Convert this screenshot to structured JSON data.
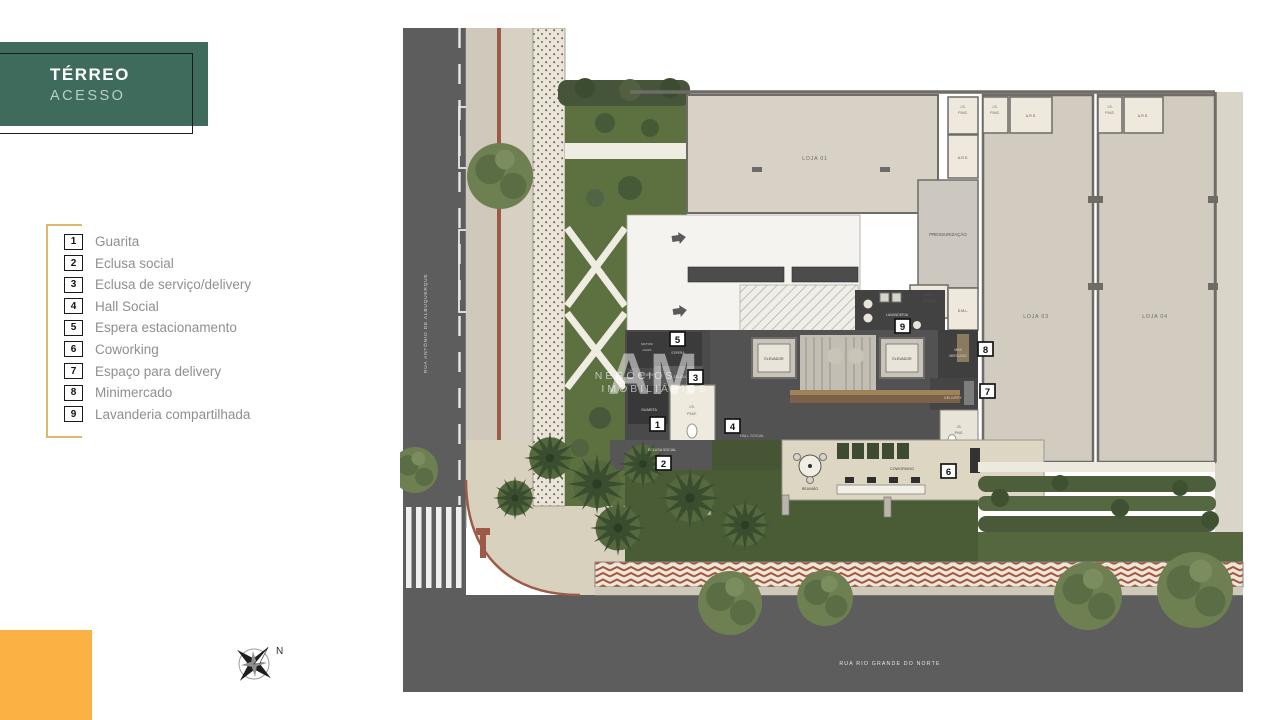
{
  "header": {
    "title": "TÉRREO",
    "subtitle": "ACESSO"
  },
  "legend": {
    "items": [
      {
        "num": "1",
        "label": "Guarita"
      },
      {
        "num": "2",
        "label": "Eclusa social"
      },
      {
        "num": "3",
        "label": "Eclusa de serviço/delivery"
      },
      {
        "num": "4",
        "label": "Hall Social"
      },
      {
        "num": "5",
        "label": "Espera estacionamento"
      },
      {
        "num": "6",
        "label": "Coworking"
      },
      {
        "num": "7",
        "label": "Espaço para delivery"
      },
      {
        "num": "8",
        "label": "Minimercado"
      },
      {
        "num": "9",
        "label": "Lavanderia compartilhada"
      }
    ]
  },
  "plan": {
    "streets": {
      "left": "RUA ANTÔNIO DE ALBUQUERQUE",
      "bottom": "RUA RIO GRANDE DO NORTE"
    },
    "markers": [
      "1",
      "2",
      "3",
      "4",
      "5",
      "6",
      "7",
      "8",
      "9"
    ],
    "rooms": {
      "loja01": "LOJA 01",
      "loja03": "LOJA 03",
      "loja04": "LOJA 04",
      "is": "I.S.",
      "pne": "P.N.E.",
      "ars": "A.R.S.",
      "pressurizacao": "PRESSURIZAÇÃO",
      "antecamara_l1": "ANTE-",
      "antecamara_l2": "CÂMARA",
      "dml": "D.M.L.",
      "lavanderia": "LAVANDERIA",
      "elevador": "ELEVADOR",
      "mini_l1": "MINI",
      "mini_l2": "MERCADO",
      "delivery": "DELIVERY",
      "guarita": "GUARITA",
      "eclusa": "ECLUSA",
      "eclusa_social": "ECLUSA SOCIAL",
      "hall_social": "HALL SOCIAL",
      "espera": "ESPERA",
      "motos_l1": "MOTOS/",
      "motos_l2": "CAIXA",
      "reuniao": "REUNIÃO",
      "coworking": "COWORKING"
    }
  },
  "watermark": {
    "logo": "AM",
    "line1": "NEGÓCIOS",
    "line2": "IMOBILIÁRIOS"
  },
  "compass": {
    "north": "N"
  },
  "colors": {
    "teal": "#3f6b5d",
    "gold": "#ddb76e",
    "orange": "#fbb143",
    "grass": "#5d7040",
    "street": "#5d5d5d"
  }
}
